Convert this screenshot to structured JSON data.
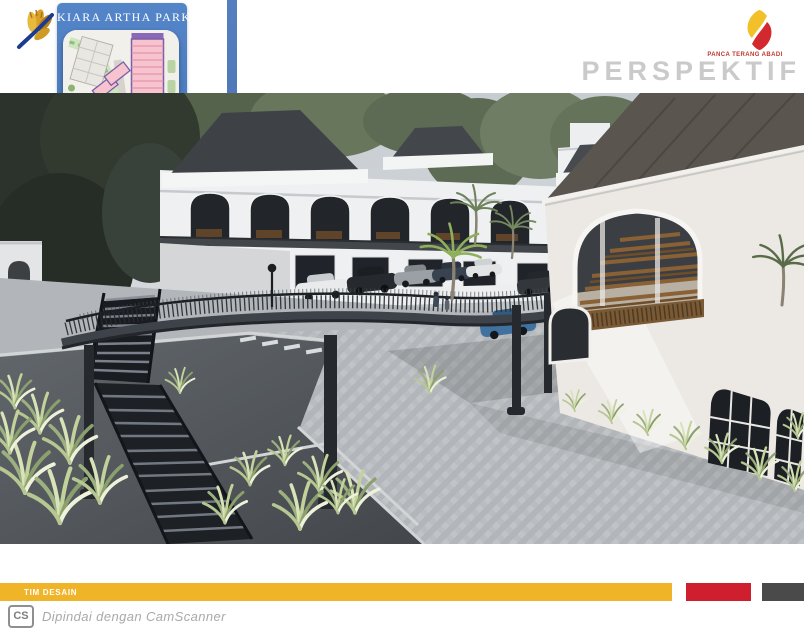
{
  "page": {
    "project_title": "KIARA ARTHA PARK",
    "company_name": "PANCA TERANG ABADI",
    "view_label": "PERSPEKTIF",
    "footer_label": "TIM DESAIN",
    "scanner_badge": "CS",
    "scanner_attribution": "Dipindai dengan CamScanner"
  },
  "colors": {
    "panel_blue": "#4a74ba",
    "accent_yellow": "#f0b429",
    "accent_red": "#cf1f2e",
    "accent_dark": "#4a4a4a",
    "logo_gold": "#d99f27",
    "logo_navy": "#1c3c8f",
    "pta_yellow": "#f2c12a",
    "pta_red": "#d3282e",
    "view_label_gray": "#cacaca"
  },
  "map_inset": {
    "name": "site-plan-thumbnail",
    "marker": "red-location-arrow",
    "block_colors": {
      "shophouse_pink": "#f6c3ce",
      "block_outline_purple": "#7b5ea7",
      "foodcourt_orange": "#f3a43e",
      "office_blue": "#a9bce0",
      "landscape_green": "#8db274",
      "road_gray": "#dcdad4"
    }
  },
  "scene": {
    "name": "architectural-perspective-render",
    "elements": [
      "arcade-building",
      "elevated-pedestrian-bridge",
      "metal-staircase",
      "parking-deck-cars",
      "foodcourt-arch-building",
      "background-building",
      "palm-trees",
      "grass-planters",
      "herringbone-plaza"
    ]
  }
}
